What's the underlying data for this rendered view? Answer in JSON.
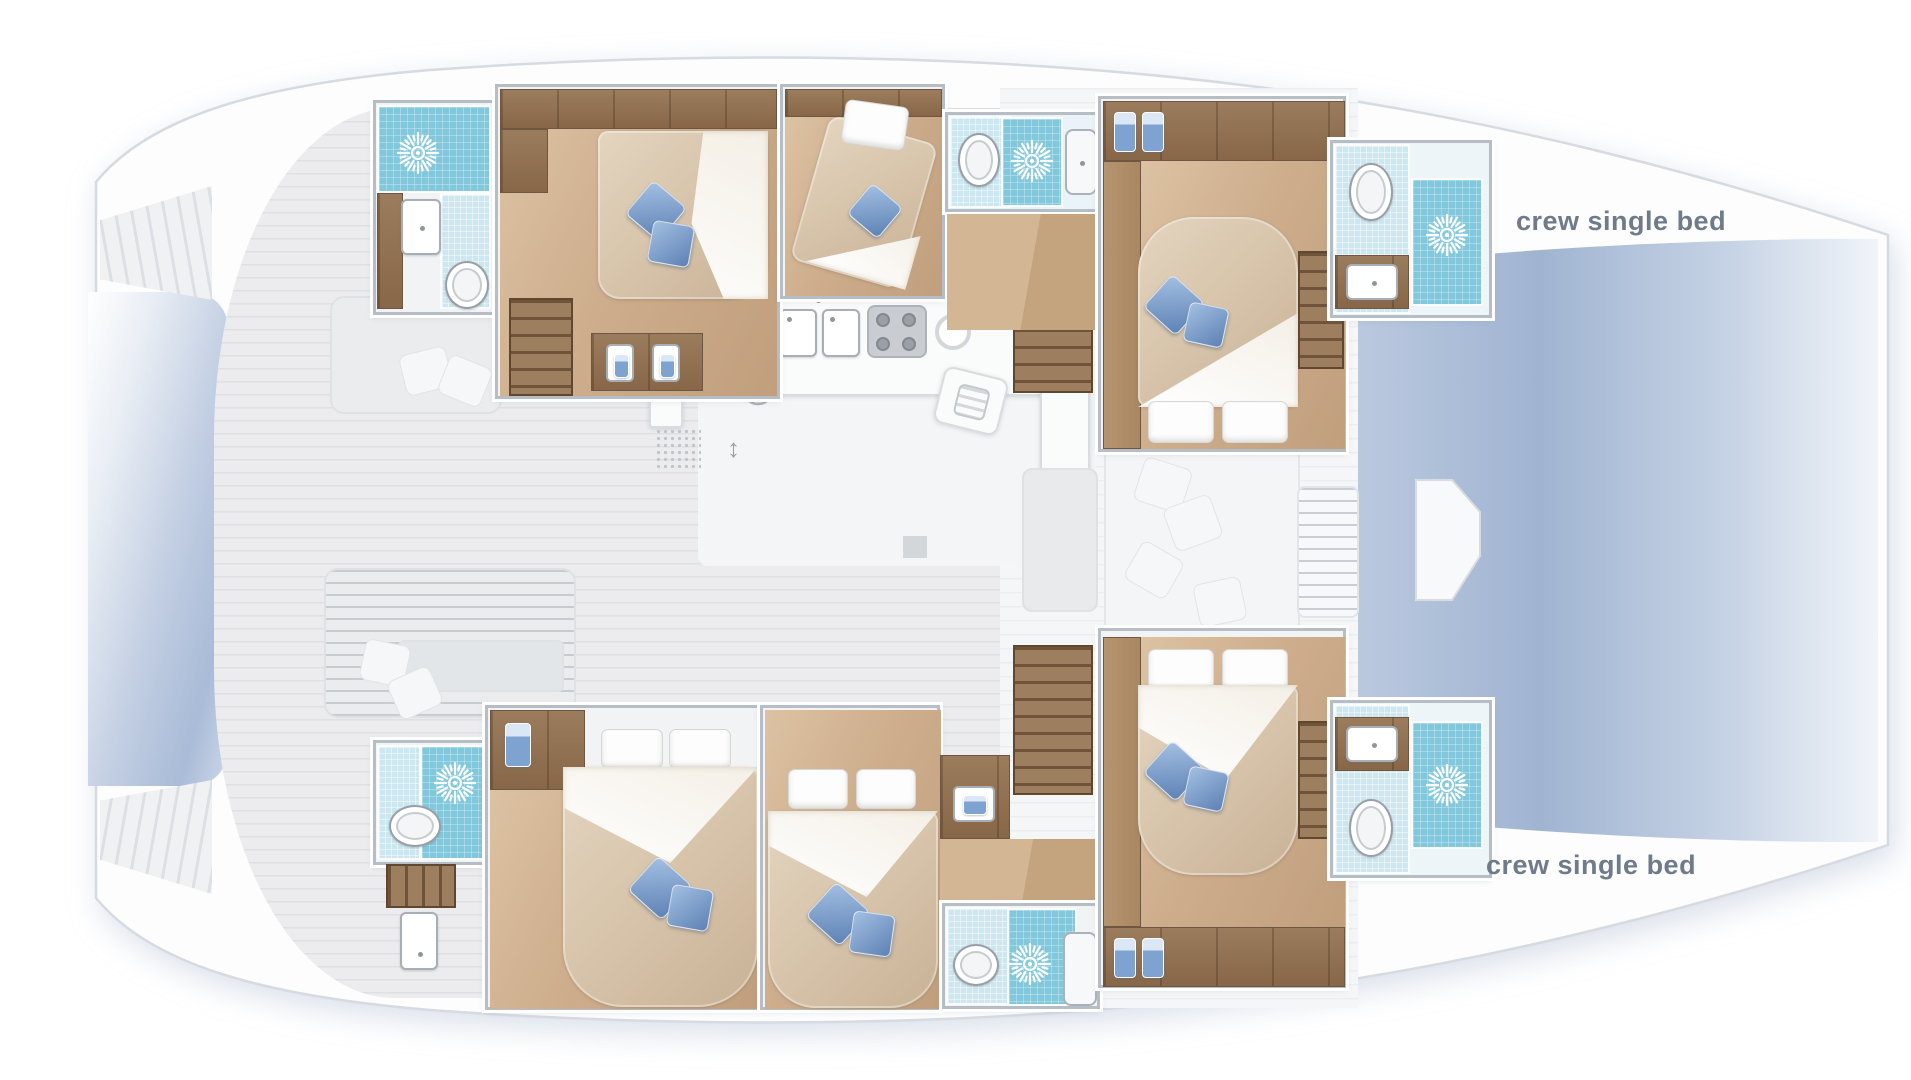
{
  "title": "Catamaran yacht interior layout floor plan (top-down deck view)",
  "labels": {
    "crew_single_bed_top": "crew single bed",
    "crew_single_bed_bottom": "crew single bed"
  },
  "palette": {
    "hull": "#fdfdfe",
    "hull_outline": "#d6dbe1",
    "deck_gray": "#ececee",
    "wood_dark": "#97785a",
    "wood_floor": "#cfb394",
    "shower_tile": "#82c8dc",
    "pale_tile": "#cde7f1",
    "water_blue": "#9db1cf",
    "mattress_beige": "#d8c6ae",
    "cushion_blue": "#6c92c4",
    "label_text": "#6f7b8b"
  },
  "vessel": {
    "type": "sailing catamaran, two hulls, bow at right, stern at left",
    "port_hull_rooms": [
      {
        "id": "head-top-aft",
        "name": "aft head",
        "fixtures": [
          "shower with jets",
          "washbasin",
          "toilet"
        ]
      },
      {
        "id": "cabin-top-aft",
        "name": "aft double cabin",
        "fixtures": [
          "double bed",
          "blue cushions",
          "wardrobe",
          "stairs",
          "twin vanity basins"
        ]
      },
      {
        "id": "cabin-top-mid",
        "name": "mid single cabin",
        "fixtures": [
          "angled berth",
          "pillow",
          "blue cushion"
        ]
      },
      {
        "id": "head-top-mid",
        "name": "mid head",
        "fixtures": [
          "toilet",
          "shower with jets",
          "shower cubicle"
        ]
      },
      {
        "id": "cabin-top-fwd",
        "name": "forward double cabin",
        "fixtures": [
          "double bed",
          "blue cushions",
          "wardrobe",
          "hanging towels",
          "stairs"
        ]
      },
      {
        "id": "head-top-fwd",
        "name": "forward head",
        "fixtures": [
          "toilet",
          "washbasin",
          "shower with jets"
        ]
      },
      {
        "id": "bow-top",
        "name": "crew berth bow area",
        "label_ref": "crew_single_bed_top"
      }
    ],
    "starboard_hull_rooms": [
      {
        "id": "head-bot-aft",
        "name": "aft head",
        "fixtures": [
          "shower with jets",
          "toilet",
          "washbasin",
          "stairs"
        ]
      },
      {
        "id": "cabin-bot-aft",
        "name": "aft double cabin",
        "fixtures": [
          "double bed",
          "blue cushions",
          "wardrobe",
          "hanging shirt"
        ]
      },
      {
        "id": "cabin-bot-mid",
        "name": "mid double cabin",
        "fixtures": [
          "double bed",
          "blue cushions"
        ]
      },
      {
        "id": "vanity-bot",
        "name": "vanity nook",
        "fixtures": [
          "washbasin"
        ]
      },
      {
        "id": "head-bot-mid",
        "name": "mid head",
        "fixtures": [
          "toilet",
          "shower with jets"
        ]
      },
      {
        "id": "cabin-bot-fwd",
        "name": "forward double cabin",
        "fixtures": [
          "double bed",
          "blue cushions",
          "wardrobe",
          "hanging towels",
          "stairs"
        ]
      },
      {
        "id": "head-bot-fwd",
        "name": "forward head",
        "fixtures": [
          "washbasin",
          "toilet",
          "shower with jets"
        ]
      },
      {
        "id": "bow-bottom",
        "name": "crew berth bow area",
        "label_ref": "crew_single_bed_bottom"
      }
    ],
    "bridgedeck": {
      "aft_cockpit": [
        "bench with cushions",
        "day bed",
        "scatter pillows",
        "transom steps both hulls"
      ],
      "saloon": [
        "galley counter",
        "double sink",
        "four-burner stove",
        "round basin",
        "fridge",
        "nav island",
        "ventilation fan",
        "floor mat",
        "companionway arrows",
        "dining table"
      ],
      "forward_cockpit": [
        "sun lounge with pillows",
        "step pad",
        "bow seat"
      ],
      "water": [
        "stern gap between hulls",
        "bow gap between hulls"
      ]
    }
  }
}
